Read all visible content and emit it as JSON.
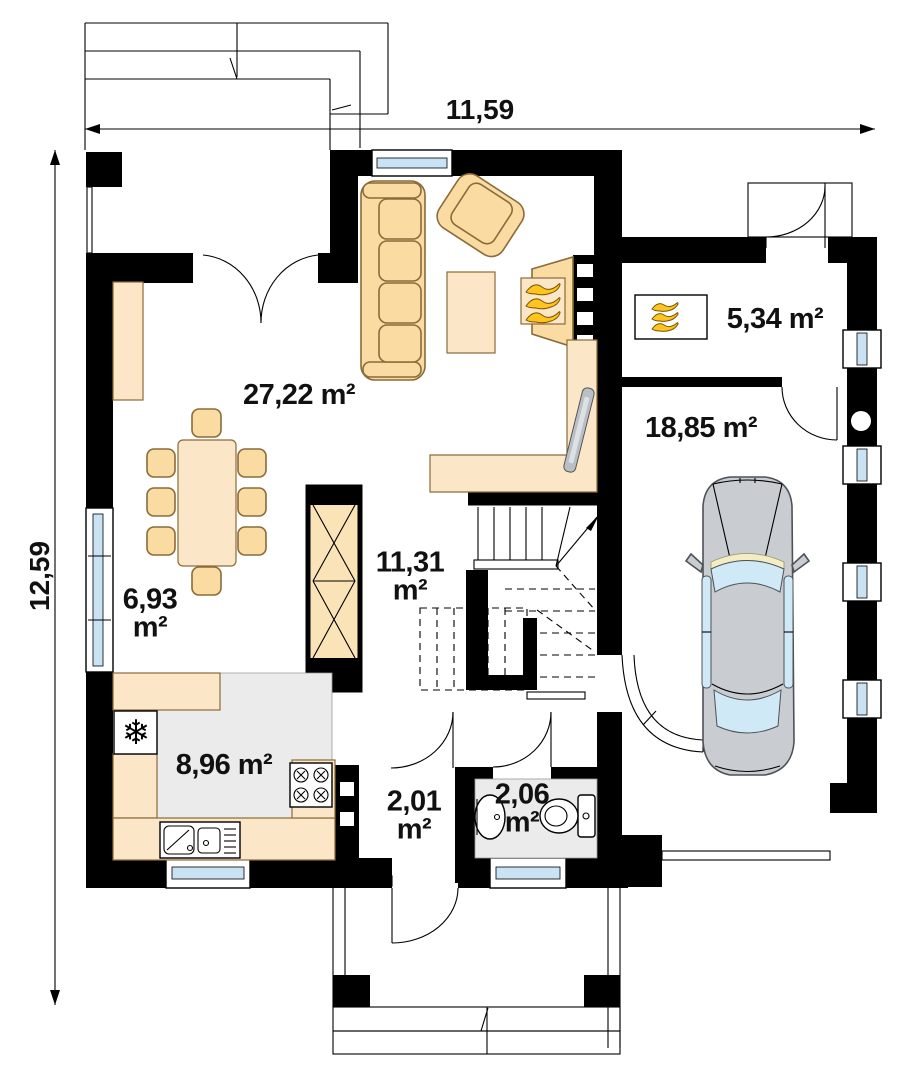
{
  "dimensions": {
    "width": "11,59",
    "height": "12,59"
  },
  "rooms": {
    "living": {
      "label": "27,22 m²"
    },
    "boiler": {
      "label": "5,34 m²"
    },
    "garage": {
      "label": "18,85 m²"
    },
    "kitchen": {
      "label": "8,96 m²"
    },
    "dining": {
      "value": "6,93",
      "unit": "m²"
    },
    "stairs": {
      "value": "11,31",
      "unit": "m²"
    },
    "vestibule": {
      "value": "2,01",
      "unit": "m²"
    },
    "wc": {
      "value": "2,06",
      "unit": "m²"
    }
  },
  "icons": {
    "snowflake": "❄"
  },
  "colors": {
    "wall": "#000000",
    "furniture": "#FADCA2",
    "furniture_light": "#FBE7C8",
    "floor_gray": "#EBEBEB",
    "glass": "#C9E3F5",
    "flame": "#FFC51E",
    "car_body": "#C9CDD1",
    "car_glass": "#CFE9F7"
  }
}
